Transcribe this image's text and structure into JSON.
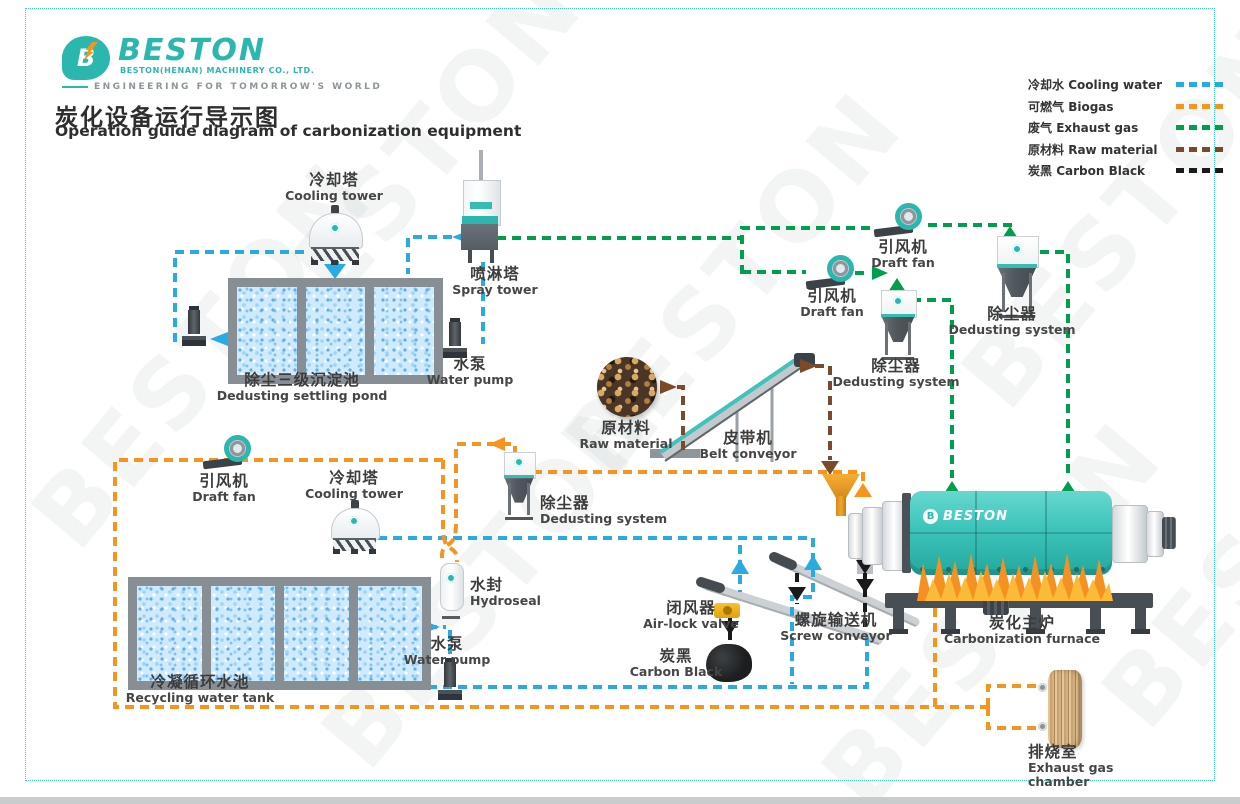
{
  "header": {
    "logo_text": "BESTON",
    "logo_letter": "B",
    "logo_sub": "BESTON(HENAN) MACHINERY CO., LTD.",
    "logo_tagline": "ENGINEERING FOR TOMORROW'S WORLD",
    "title_zh": "炭化设备运行导示图",
    "title_en": "Operation guide diagram of carbonization equipment"
  },
  "legend": {
    "items": [
      {
        "zh": "冷却水",
        "en": "Cooling water",
        "color": "#29ABE2"
      },
      {
        "zh": "可燃气",
        "en": "Biogas",
        "color": "#F7941E"
      },
      {
        "zh": "废气",
        "en": "Exhaust gas",
        "color": "#009F4D"
      },
      {
        "zh": "原材料",
        "en": "Raw material",
        "color": "#7B4A2B"
      },
      {
        "zh": "炭黑",
        "en": "Carbon Black",
        "color": "#1A1A1A"
      }
    ]
  },
  "colors": {
    "brand_teal": "#2BB7AE",
    "cooling_water": "#29ABE2",
    "biogas": "#F7941E",
    "exhaust_gas": "#009F4D",
    "raw_material": "#7B4A2B",
    "carbon_black": "#1A1A1A"
  },
  "equipment": {
    "cooling_tower_top": {
      "zh": "冷却塔",
      "en": "Cooling tower"
    },
    "spray_tower": {
      "zh": "喷淋塔",
      "en": "Spray tower"
    },
    "water_pump_top": {
      "zh": "水泵",
      "en": "Water pump"
    },
    "settling_pond": {
      "zh": "除尘三级沉淀池",
      "en": "Dedusting settling pond"
    },
    "draft_fan_top": {
      "zh": "引风机",
      "en": "Draft fan"
    },
    "draft_fan_mid": {
      "zh": "引风机",
      "en": "Draft fan"
    },
    "dedusting_mid": {
      "zh": "除尘器",
      "en": "Dedusting system"
    },
    "dedusting_right": {
      "zh": "除尘器",
      "en": "Dedusting system"
    },
    "raw_material": {
      "zh": "原材料",
      "en": "Raw material"
    },
    "belt_conveyor": {
      "zh": "皮带机",
      "en": "Belt conveyor"
    },
    "draft_fan_bottom": {
      "zh": "引风机",
      "en": "Draft fan"
    },
    "cooling_tower_bottom": {
      "zh": "冷却塔",
      "en": "Cooling tower"
    },
    "dedusting_low": {
      "zh": "除尘器",
      "en": "Dedusting system"
    },
    "hydroseal": {
      "zh": "水封",
      "en": "Hydroseal"
    },
    "water_pump_bottom": {
      "zh": "水泵",
      "en": "Water pump"
    },
    "recycling_tank": {
      "zh": "冷凝循环水池",
      "en": "Recycling water tank"
    },
    "air_lock_valve": {
      "zh": "闭风器",
      "en": "Air-lock valve"
    },
    "screw_conveyor": {
      "zh": "螺旋输送机",
      "en": "Screw conveyor"
    },
    "carbon_black": {
      "zh": "炭黑",
      "en": "Carbon Black"
    },
    "furnace": {
      "zh": "炭化主炉",
      "en": "Carbonization furnace"
    },
    "exhaust_chamber": {
      "zh": "排烧室",
      "en": "Exhaust gas chamber"
    }
  },
  "furnace_logo": "BESTON",
  "watermark": {
    "text": "BESTON"
  }
}
